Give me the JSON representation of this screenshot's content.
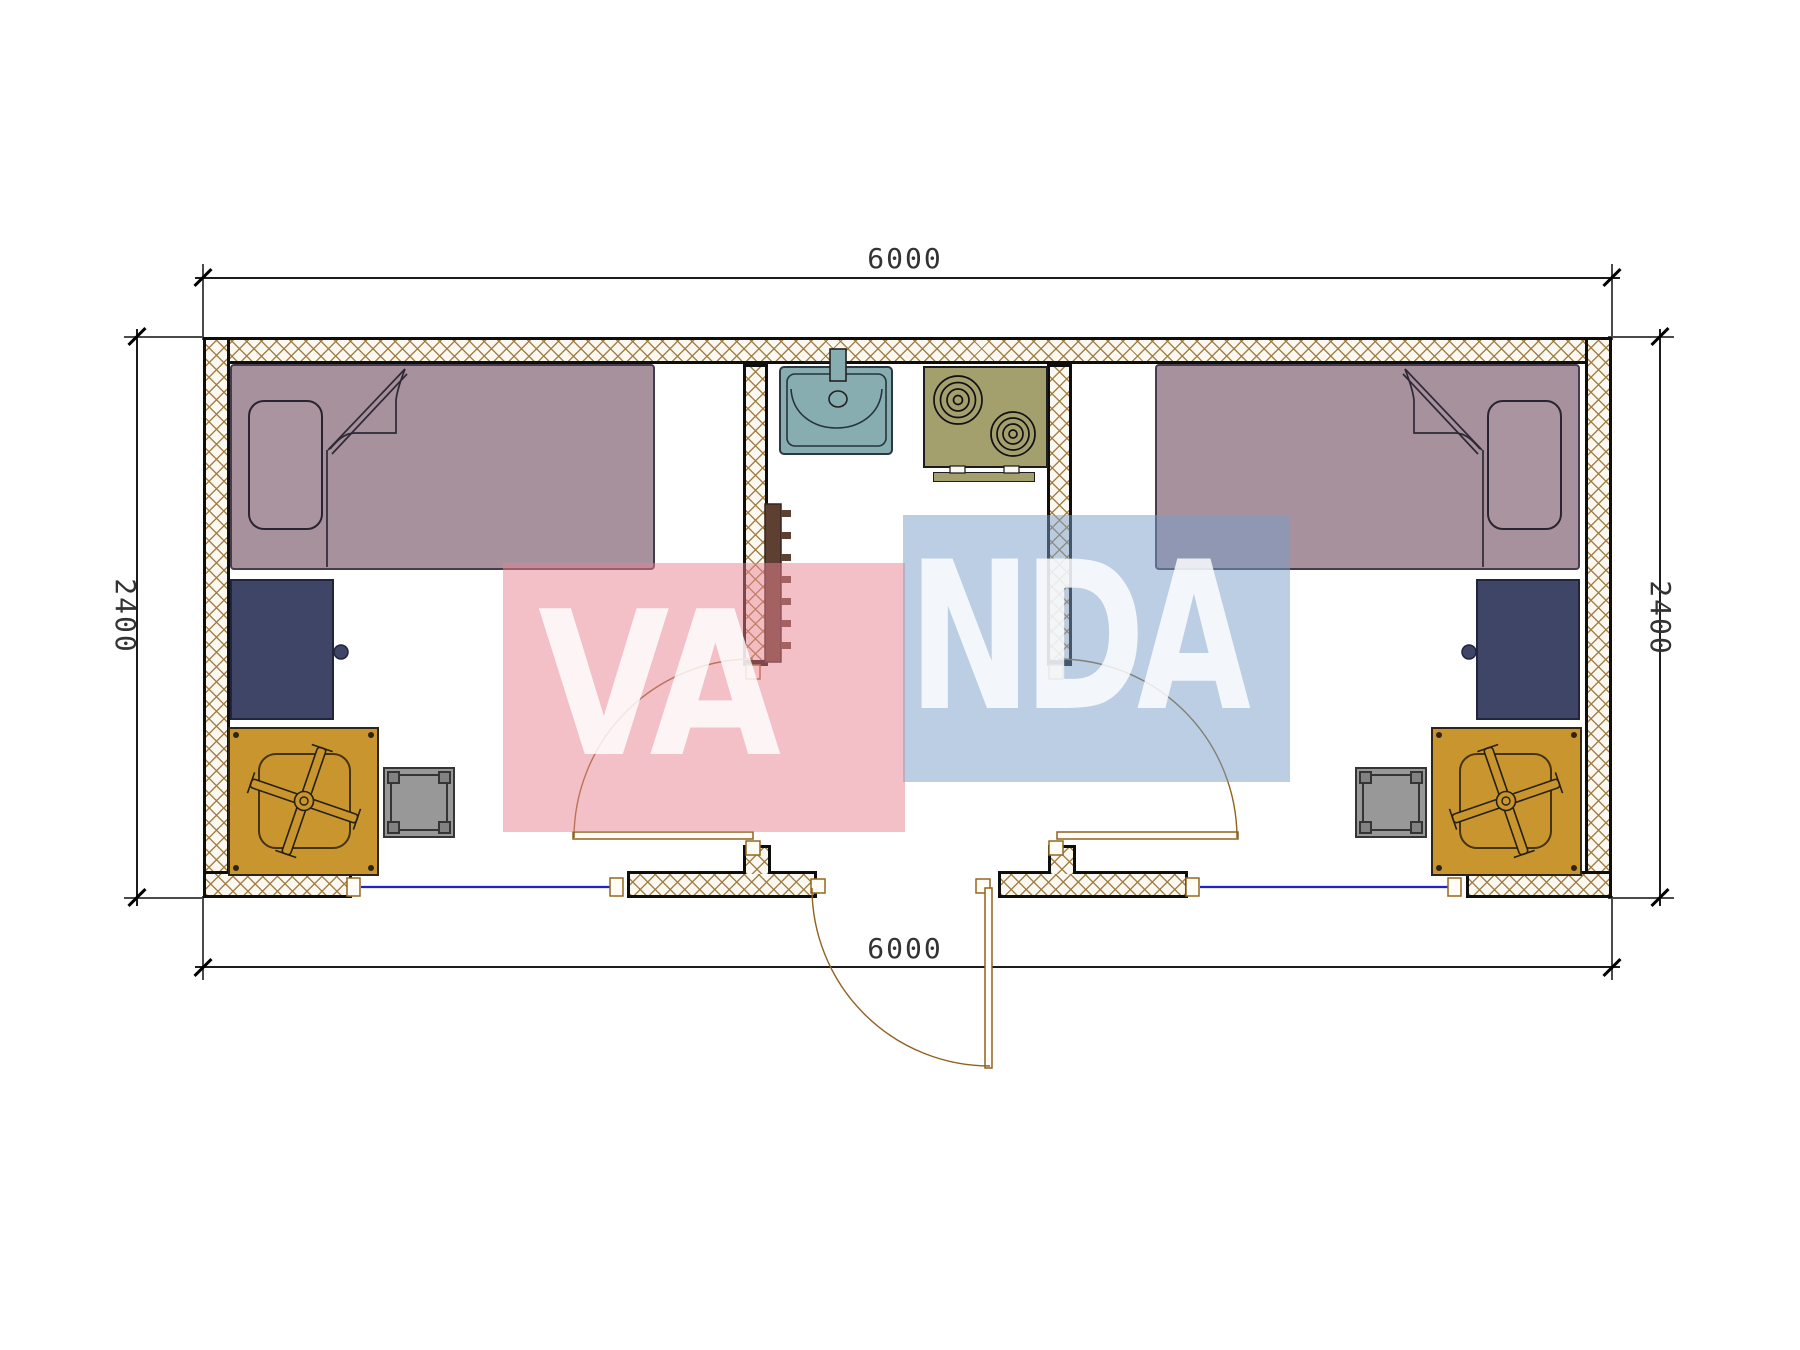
{
  "dimensions": {
    "top": "6000",
    "bottom": "6000",
    "left": "2400",
    "right": "2400"
  },
  "watermark": {
    "left_text": "VA",
    "right_text": "NDA",
    "pink_box_color": "#ec8a97",
    "blue_box_color": "#78a0c7",
    "letter_color": "#ffffff"
  },
  "colors": {
    "wall_hatch": "#a07c40",
    "bed": "#a6919d",
    "desk": "#3e4566",
    "chair": "#c9952f",
    "stool": "#989898",
    "sink": "#87adb1",
    "stove": "#a3a06e",
    "door": "#8f6220",
    "window": "#2222c8",
    "rack": "#5e4033"
  }
}
